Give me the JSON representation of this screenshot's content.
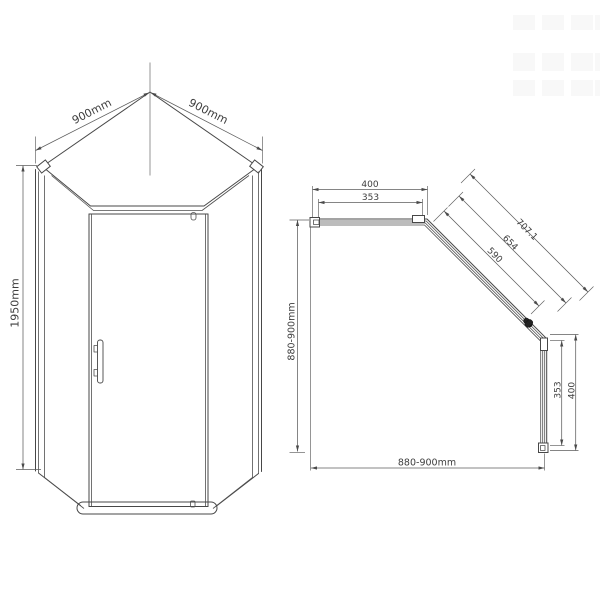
{
  "drawing": {
    "description": "Technical dimension drawing of a pentagonal corner shower enclosure, front perspective view and top plan view",
    "background": "#ffffff",
    "line_color": "#474747",
    "text_color": "#3d3d3d"
  },
  "front_view": {
    "dims": {
      "width_left": "900mm",
      "width_right": "900mm",
      "height": "1950mm"
    }
  },
  "plan_view": {
    "dims": {
      "top_outer": "400",
      "top_inner": "353",
      "diagonal_outer": "707.1",
      "diagonal_middle": "654",
      "diagonal_inner": "590",
      "left_side": "880-900mm",
      "bottom_side": "880-900mm",
      "right_inner": "353",
      "right_outer": "400"
    }
  }
}
